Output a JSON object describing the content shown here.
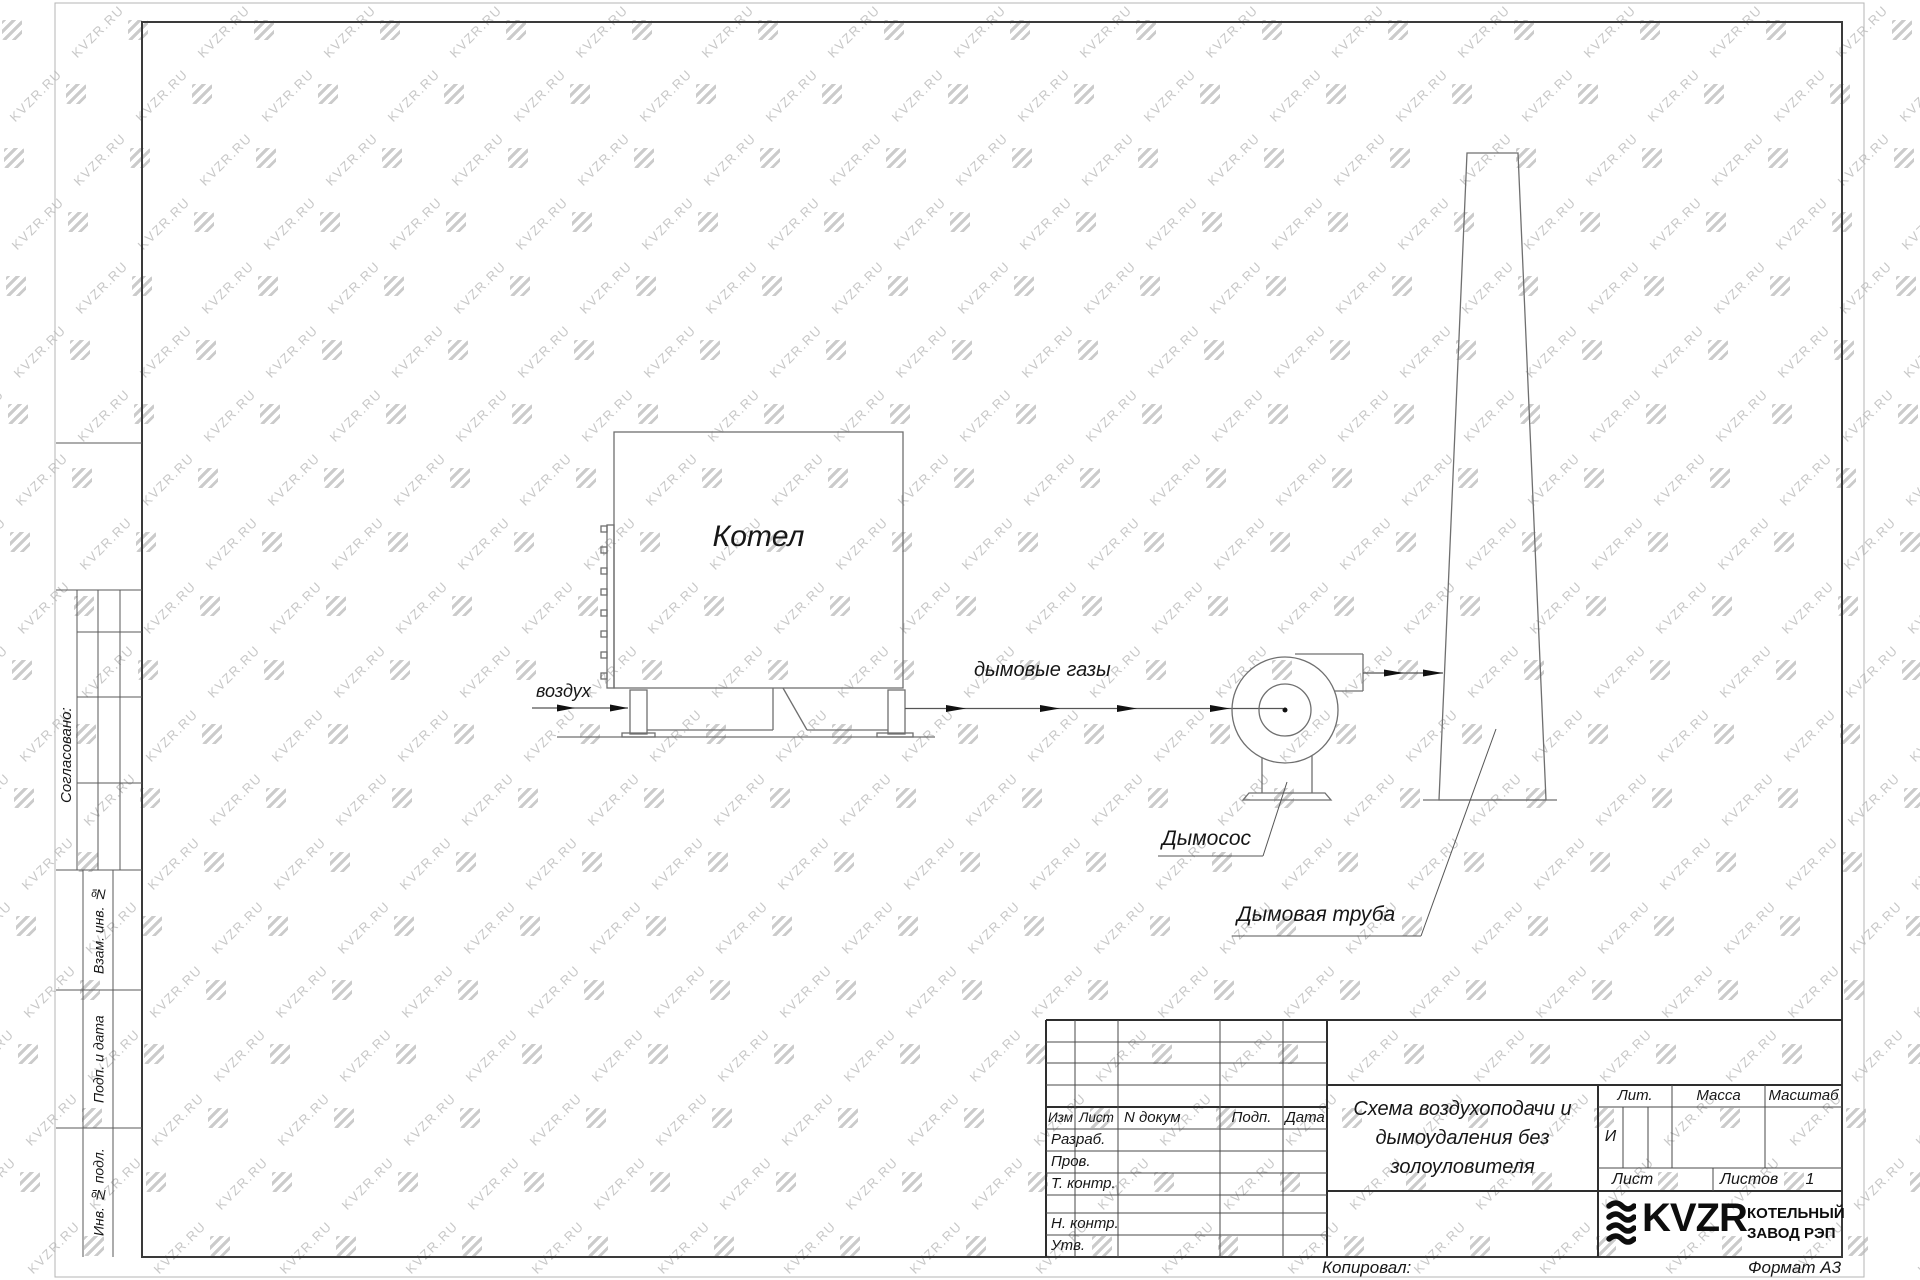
{
  "watermark": {
    "text": "KVZR.RU"
  },
  "sidebar": {
    "approved": "Согласовано:",
    "vzam": "Взам. инв. №",
    "podp_data": "Подп. и дата",
    "inv_podl": "Инв. № подл."
  },
  "diagram": {
    "boiler_label": "Котел",
    "air_label": "воздух",
    "flue_label": "дымовые газы",
    "fan_label": "Дымосос",
    "chimney_label": "Дымовая труба"
  },
  "titleblock": {
    "rev_header": {
      "izm": "Изм",
      "list": "Лист",
      "ndoc": "N докум",
      "podp": "Подп.",
      "data": "Дата"
    },
    "roles": {
      "r1": "Разраб.",
      "r2": "Пров.",
      "r3": "Т. контр.",
      "r4": "Н. контр.",
      "r5": "Утв."
    },
    "title_line1": "Схема воздухоподачи и",
    "title_line2": "дымоудаления без",
    "title_line3": "золоуловителя",
    "lit_header": "Лит.",
    "massa_header": "Масса",
    "masshtab_header": "Масштаб",
    "lit_value": "И",
    "list_label": "Лист",
    "listov_label": "Листов",
    "listov_value": "1",
    "company_brand": "KVZR",
    "company_line1": "КОТЕЛЬНЫЙ",
    "company_line2": "ЗАВОД РЭП"
  },
  "footer": {
    "copied_label": "Копировал:",
    "format_label": "Формат А3"
  }
}
